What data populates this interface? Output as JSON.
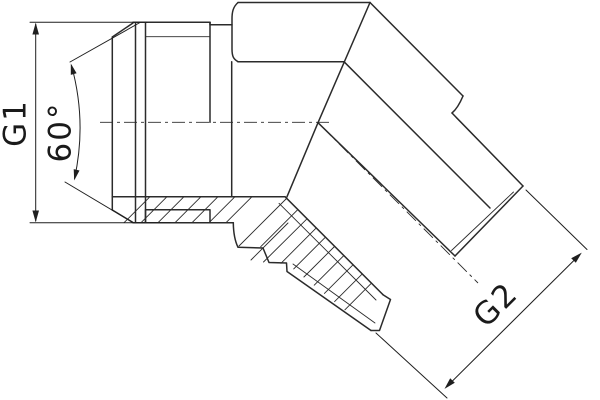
{
  "labels": {
    "g1": "G1",
    "angle": "60°",
    "g2": "G2"
  },
  "colors": {
    "line": "#2b2b2b",
    "dimension_text": "#1a1a1a",
    "background": "#ffffff"
  }
}
